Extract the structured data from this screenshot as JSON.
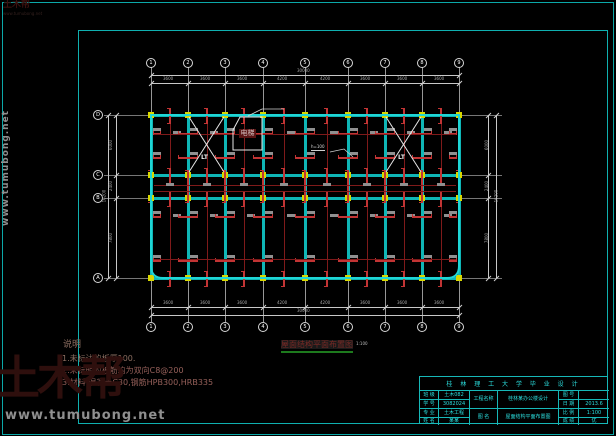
{
  "colors": {
    "background": "#000000",
    "frame_cyan": "#0fb0b0",
    "beam_cyan": "#0fb6b6",
    "slab_outline": "#1fd6d6",
    "column_yellow": "#d8d800",
    "rebar_red": "#c23434",
    "rebar_dark_red": "#7f1a1a",
    "dim_gray": "#a8a8a8",
    "axis_white": "#d8d8d8",
    "title_cyan": "#2bdede",
    "note_brown": "#8d6f62",
    "caption_red": "#7a2a26",
    "caption_underline_green": "#1d7a1d",
    "watermark_gray": "#8f8f8f",
    "watermark_maroon": "#2e0f0d"
  },
  "watermark": {
    "site": "www.tumubong.net",
    "logo": "土木帮"
  },
  "grid": {
    "cols": [
      "1",
      "2",
      "3",
      "4",
      "5",
      "6",
      "7",
      "8",
      "9"
    ],
    "rows": [
      "D",
      "C",
      "B",
      "A"
    ]
  },
  "geometry": {
    "col_x": [
      151,
      188,
      225,
      263,
      305,
      348,
      385,
      422,
      459
    ],
    "row_y": [
      115,
      175,
      198,
      278
    ]
  },
  "dimensions": {
    "top_bays": [
      "3600",
      "3600",
      "3600",
      "4200",
      "4200",
      "3600",
      "3600",
      "3600"
    ],
    "top_overall": "30000",
    "bottom_bays": [
      "3600",
      "3600",
      "3600",
      "4200",
      "4200",
      "3600",
      "3600",
      "3600"
    ],
    "bottom_overall": "30000",
    "left_segments": [
      "6000",
      "2400",
      "7800"
    ],
    "left_overall": "16200",
    "right_segments": [
      "6000",
      "2400",
      "7800"
    ],
    "right_overall": "16200"
  },
  "plan": {
    "stair_label": "LT",
    "elevator_label": "电梯",
    "annotation": "h=100",
    "caption": "屋面结构平面布置图",
    "caption_scale": "1:100"
  },
  "notes": {
    "title": "说明",
    "lines": [
      "1.未标注的板厚100.",
      "2.未标明的板筋均为双向C8@200",
      "3.材料:混凝土C30,钢筋HPB300,HRB335"
    ]
  },
  "title_block": {
    "header": "桂 林 理 工 大 学 毕 业 设 计",
    "left_rows": [
      {
        "label": "班 级",
        "value": "土木082"
      },
      {
        "label": "学 号",
        "value": "3082024"
      },
      {
        "label": "专 业",
        "value": "土木工程"
      },
      {
        "label": "姓 名",
        "value": "某某"
      }
    ],
    "mid_rows": [
      {
        "label": "工程名称",
        "value": "桂林某办公楼设计"
      },
      {
        "label": "图 名",
        "value": "屋面结构平面布置图"
      }
    ],
    "right_rows": [
      {
        "label": "图 号",
        "value": ""
      },
      {
        "label": "日 期",
        "value": "2013.6"
      },
      {
        "label": "比 例",
        "value": "1:100"
      },
      {
        "label": "成 绩",
        "value": "优"
      }
    ]
  }
}
